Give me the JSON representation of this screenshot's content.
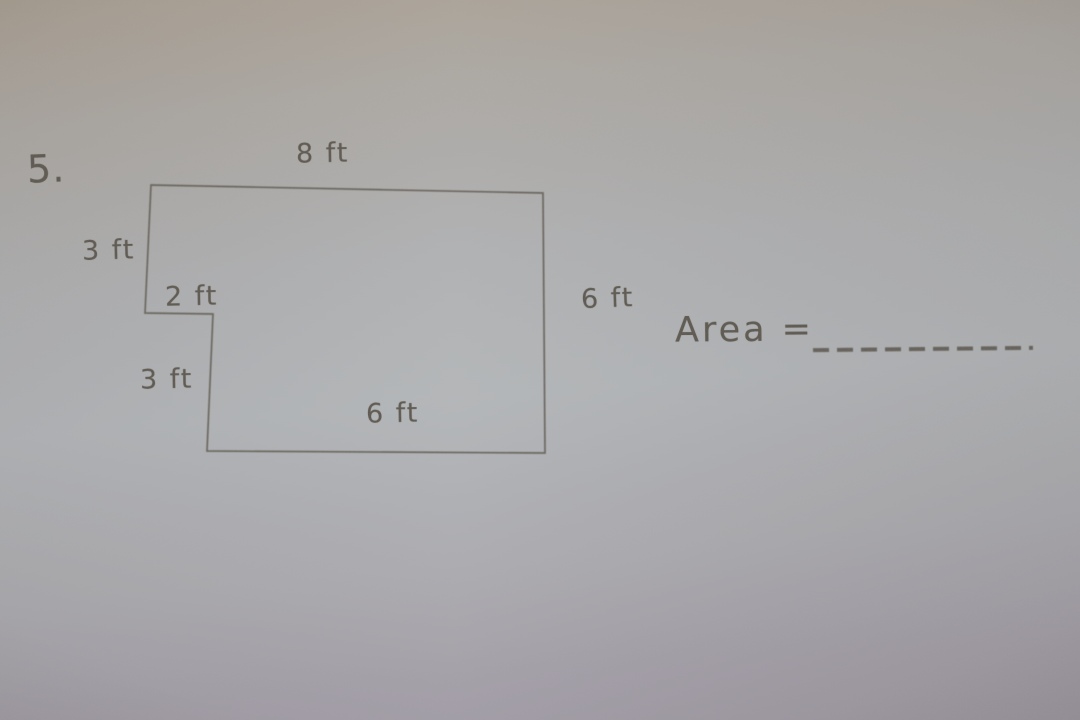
{
  "problem": {
    "number": "5.",
    "area_prompt": "Area =",
    "answer_blank": "_________"
  },
  "figure": {
    "type": "rectilinear-polygon",
    "unit": "ft",
    "labels": {
      "top": "8 ft",
      "left_upper": "3 ft",
      "notch": "2 ft",
      "left_lower": "3 ft",
      "bottom": "6 ft",
      "right": "6 ft"
    }
  },
  "colors": {
    "pencil": "#5b564d",
    "paper_top": "#a69c8f",
    "paper_middle": "#b0b3b6",
    "paper_bottom": "#98939d"
  }
}
